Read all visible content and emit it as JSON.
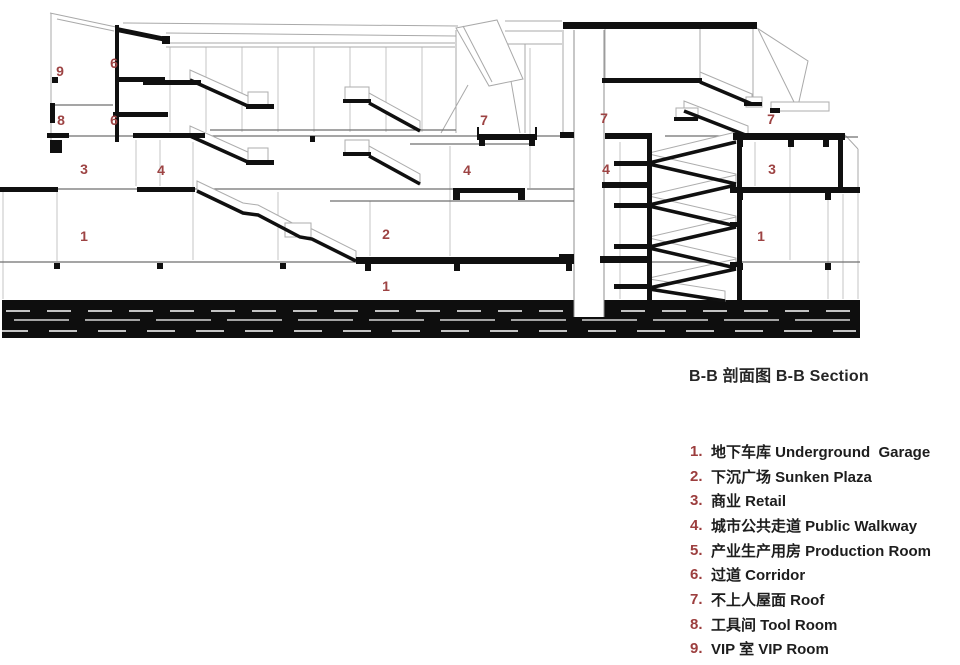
{
  "drawing": {
    "caption": "B-B 剖面图 B-B Section",
    "labels": [
      {
        "text": "9"
      },
      {
        "text": "6"
      },
      {
        "text": "8"
      },
      {
        "text": "6"
      },
      {
        "text": "3"
      },
      {
        "text": "4"
      },
      {
        "text": "7"
      },
      {
        "text": "4"
      },
      {
        "text": "7"
      },
      {
        "text": "4"
      },
      {
        "text": "7"
      },
      {
        "text": "3"
      },
      {
        "text": "1"
      },
      {
        "text": "2"
      },
      {
        "text": "1"
      },
      {
        "text": "1"
      }
    ],
    "colors": {
      "label_red": "#9d4343",
      "ink": "#101010",
      "line_gray": "#a9a9a9"
    }
  },
  "legend": {
    "items": [
      {
        "num": "1.",
        "text": "地下车库 Underground  Garage"
      },
      {
        "num": "2.",
        "text": "下沉广场 Sunken Plaza"
      },
      {
        "num": "3.",
        "text": "商业 Retail"
      },
      {
        "num": "4.",
        "text": "城市公共走道 Public Walkway"
      },
      {
        "num": "5.",
        "text": "产业生产用房 Production Room"
      },
      {
        "num": "6.",
        "text": "过道 Corridor"
      },
      {
        "num": "7.",
        "text": "不上人屋面 Roof"
      },
      {
        "num": "8.",
        "text": "工具间 Tool Room"
      },
      {
        "num": "9.",
        "text": "VIP 室 VIP Room"
      }
    ]
  }
}
